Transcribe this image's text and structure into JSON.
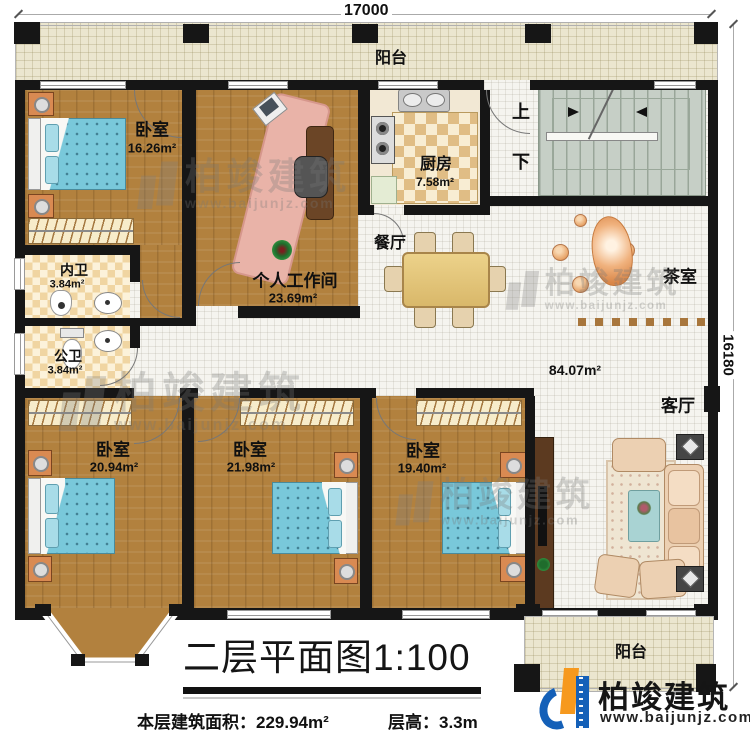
{
  "title": {
    "text": "二层平面图1:100"
  },
  "footer": {
    "area_label": "本层建筑面积：",
    "area_value": "229.94m²",
    "height_label": "层高：",
    "height_value": "3.3m"
  },
  "dimensions": {
    "width": "17000",
    "height": "16180"
  },
  "brand": {
    "name": "柏竣建筑",
    "url": "www.baijunjz.com",
    "blue": "#1460b8",
    "orange": "#f6991e"
  },
  "rooms": {
    "balcony_top": {
      "label": "阳台"
    },
    "balcony_bottom": {
      "label": "阳台"
    },
    "bedroom_tl": {
      "label": "卧室",
      "area": "16.26m²"
    },
    "workroom": {
      "label": "个人工作间",
      "area": "23.69m²"
    },
    "kitchen": {
      "label": "厨房",
      "area": "7.58m²"
    },
    "bath_inner": {
      "label": "内卫",
      "area": "3.84m²"
    },
    "bath_public": {
      "label": "公卫",
      "area": "3.84m²"
    },
    "dining": {
      "label": "餐厅"
    },
    "tea_room": {
      "label": "茶室"
    },
    "living": {
      "label": "客厅"
    },
    "open_area": {
      "area": "84.07m²"
    },
    "bedroom_bl": {
      "label": "卧室",
      "area": "20.94m²"
    },
    "bedroom_bm": {
      "label": "卧室",
      "area": "21.98m²"
    },
    "bedroom_br": {
      "label": "卧室",
      "area": "19.40m²"
    }
  },
  "stairs": {
    "up": "上",
    "down": "下"
  },
  "colors": {
    "wall": "#161616",
    "wood": "#b2813e",
    "balcony": "#ebe6cf",
    "stairs": "#c6cfc6",
    "bed": "#79c8da"
  }
}
